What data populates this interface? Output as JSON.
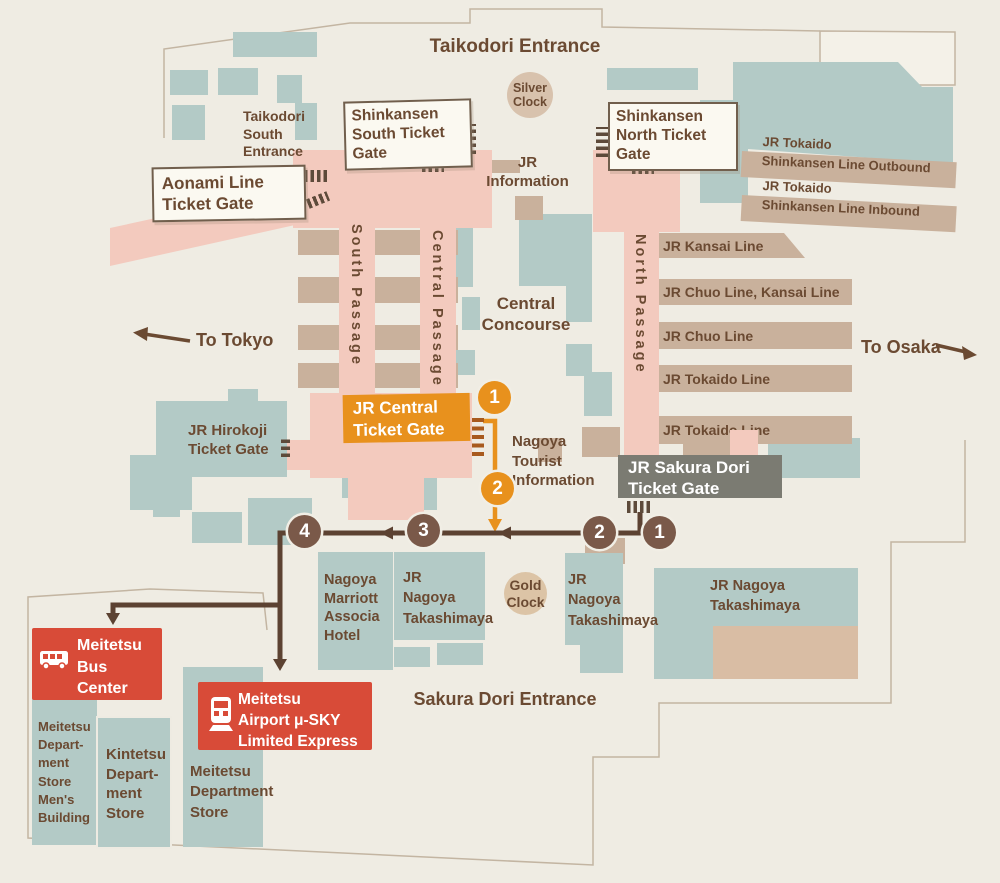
{
  "map": {
    "entrances": {
      "taikodori": "Taikodori Entrance",
      "taikodori_south": "Taikodori\nSouth\nEntrance",
      "sakura_dori": "Sakura Dori Entrance"
    },
    "clocks": {
      "silver": "Silver\nClock",
      "gold": "Gold\nClock"
    },
    "gates": {
      "shinkansen_south": "Shinkansen\nSouth Ticket\nGate",
      "shinkansen_north": "Shinkansen\nNorth Ticket\nGate",
      "aonami": "Aonami Line\nTicket Gate",
      "jr_central": "JR Central\nTicket Gate",
      "jr_sakura_dori": "JR Sakura Dori\nTicket Gate",
      "jr_hirokoji": "JR Hirokoji\nTicket Gate"
    },
    "info": {
      "jr_information": "JR\nInformation",
      "tourist_information": "Nagoya\nTourist\nInformation",
      "central_concourse": "Central\nConcourse"
    },
    "passages": {
      "south": "South Passage",
      "central": "Central Passage",
      "north": "North Passage"
    },
    "lines": {
      "shinkansen_outbound": "JR Tokaido\nShinkansen Line Outbound",
      "shinkansen_inbound": "JR Tokaido\nShinkansen Line Inbound",
      "kansai": "JR Kansai Line",
      "chuo_kansai": "JR Chuo Line, Kansai Line",
      "chuo": "JR Chuo Line",
      "tokaido_1": "JR Tokaido Line",
      "tokaido_2": "JR Tokaido Line"
    },
    "directions": {
      "to_tokyo": "To Tokyo",
      "to_osaka": "To Osaka"
    },
    "buildings": {
      "marriott": "Nagoya\nMarriott\nAssocia\nHotel",
      "takashimaya_1": "JR\nNagoya\nTakashimaya",
      "takashimaya_2": "JR\nNagoya\nTakashimaya",
      "takashimaya_3": "JR Nagoya\nTakashimaya",
      "meitetsu_mens": "Meitetsu\nDepart-\nment\nStore\nMen's\nBuilding",
      "kintetsu": "Kintetsu\nDepart-\nment\nStore",
      "meitetsu_dept": "Meitetsu\nDepartment\nStore"
    },
    "transit": {
      "bus_center": "Meitetsu\nBus\nCenter",
      "mu_sky": "Meitetsu\nAirport μ-SKY\nLimited Express"
    },
    "route_steps": {
      "orange": [
        "1",
        "2"
      ],
      "brown": [
        "1",
        "2",
        "3",
        "4"
      ]
    },
    "colors": {
      "accent_orange": "#E8911D",
      "route_brown": "#5C4232",
      "badge_brown": "#7A5949",
      "red": "#D84B38",
      "teal": "#B3CAC6",
      "pink": "#F3CABE",
      "tan": "#C9B19C",
      "gate_gray": "#7B7B72",
      "text_brown": "#6B4A32"
    }
  }
}
